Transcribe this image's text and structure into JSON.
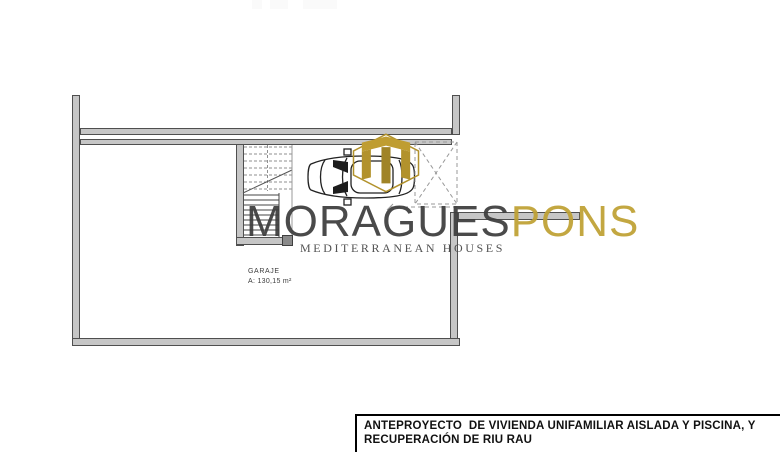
{
  "plan": {
    "room_label": "GARAJE",
    "room_area": "A: 130,15 m²"
  },
  "logo": {
    "name_primary": "MORAGUES",
    "name_secondary": "PONS",
    "tagline": "MEDITERRANEAN HOUSES",
    "icon": "gold-monogram-house-icon",
    "gold_color": "#b2922c",
    "dark_color": "#3d3d3d"
  },
  "title_block": {
    "lines": [
      "ANTEPROYECTO  DE VIVIENDA UNIFAMILIAR AISLADA Y PISCINA, Y",
      "RECUPERACIÓN DE RIU RAU"
    ]
  },
  "colors": {
    "wall_fill": "#c6c6c6",
    "wall_edge": "#4f4f4f",
    "dashed_line": "#999999",
    "background": "#ffffff"
  }
}
